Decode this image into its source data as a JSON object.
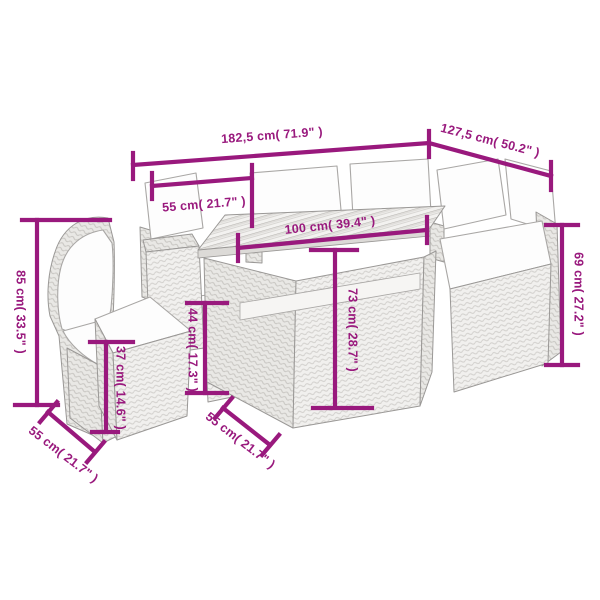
{
  "diagram": {
    "type": "product-dimension-diagram",
    "subject": "rattan garden lounge furniture set with cushions and wood-top table",
    "background_color": "#ffffff",
    "dimension_color": "#99197D",
    "furniture_outline_color": "#9a9896",
    "rattan_fill_color": "#f1f0ee",
    "cushion_fill_color": "#fdfdfd",
    "pieces": [
      "corner-chair-left",
      "footstool",
      "center-sofa",
      "wood-top-table",
      "table-storage-base",
      "right-corner-sofa"
    ],
    "dimensions": [
      {
        "id": "overall-width",
        "cm": "182,5",
        "inch": "71.9",
        "label": "182,5 cm( 71.9\" )"
      },
      {
        "id": "overall-depth",
        "cm": "127,5",
        "inch": "50.2",
        "label": "127,5 cm( 50.2\" )"
      },
      {
        "id": "seat-width",
        "cm": "55",
        "inch": "21.7",
        "label": "55 cm( 21.7\" )"
      },
      {
        "id": "table-length",
        "cm": "100",
        "inch": "39.4",
        "label": "100 cm( 39.4\" )"
      },
      {
        "id": "armrest-height",
        "cm": "69",
        "inch": "27.2",
        "label": "69 cm( 27.2\" )"
      },
      {
        "id": "backrest-height",
        "cm": "85",
        "inch": "33.5",
        "label": "85 cm( 33.5\" )"
      },
      {
        "id": "footstool-height",
        "cm": "37",
        "inch": "14.6",
        "label": "37 cm( 14.6\" )"
      },
      {
        "id": "seat-height",
        "cm": "44",
        "inch": "17.3",
        "label": "44 cm( 17.3\" )"
      },
      {
        "id": "table-height",
        "cm": "73",
        "inch": "28.7",
        "label": "73 cm( 28.7\" )"
      },
      {
        "id": "seat-depth",
        "cm": "55",
        "inch": "21.7",
        "label": "55 cm( 21.7\" )"
      },
      {
        "id": "base-depth",
        "cm": "55",
        "inch": "21.7",
        "label": "55 cm( 21.7\" )"
      }
    ]
  }
}
